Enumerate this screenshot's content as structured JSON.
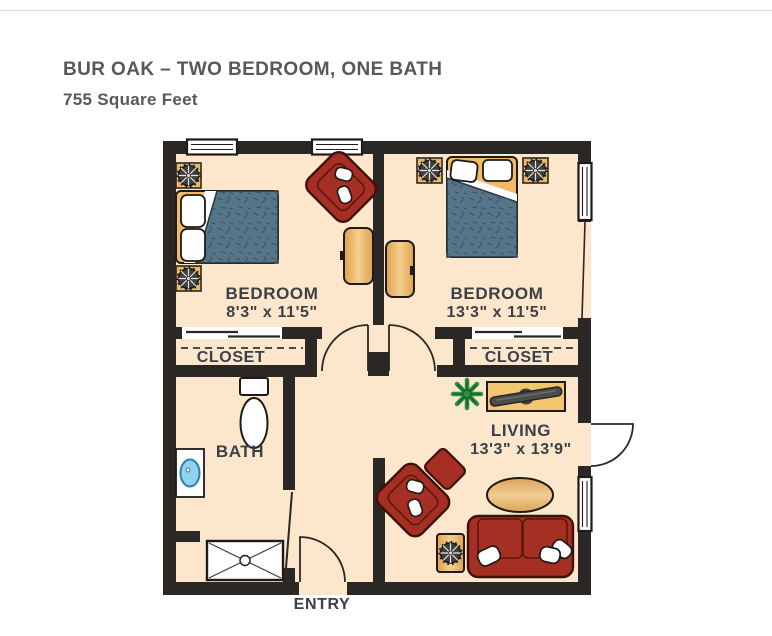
{
  "header": {
    "title": "BUR OAK – TWO BEDROOM, ONE BATH",
    "subtitle": "755 Square Feet"
  },
  "floor_plan": {
    "rooms": {
      "bedroom_left": {
        "label": "BEDROOM",
        "dimensions": "8'3\" x 11'5\""
      },
      "bedroom_right": {
        "label": "BEDROOM",
        "dimensions": "13'3\" x 11'5\""
      },
      "closet_left": {
        "label": "CLOSET"
      },
      "closet_right": {
        "label": "CLOSET"
      },
      "bath": {
        "label": "BATH"
      },
      "living": {
        "label": "LIVING",
        "dimensions": "13'3\" x 13'9\""
      },
      "entry": {
        "label": "ENTRY"
      }
    },
    "colors": {
      "wall": "#2b2725",
      "floor": "#fce6cc",
      "wood": "#eeb768",
      "upholstery_red": "#a42f22",
      "bedding_blue": "#567589",
      "plant_green": "#2f9040",
      "label_text": "#3b4046",
      "title_text": "#57585a"
    }
  }
}
